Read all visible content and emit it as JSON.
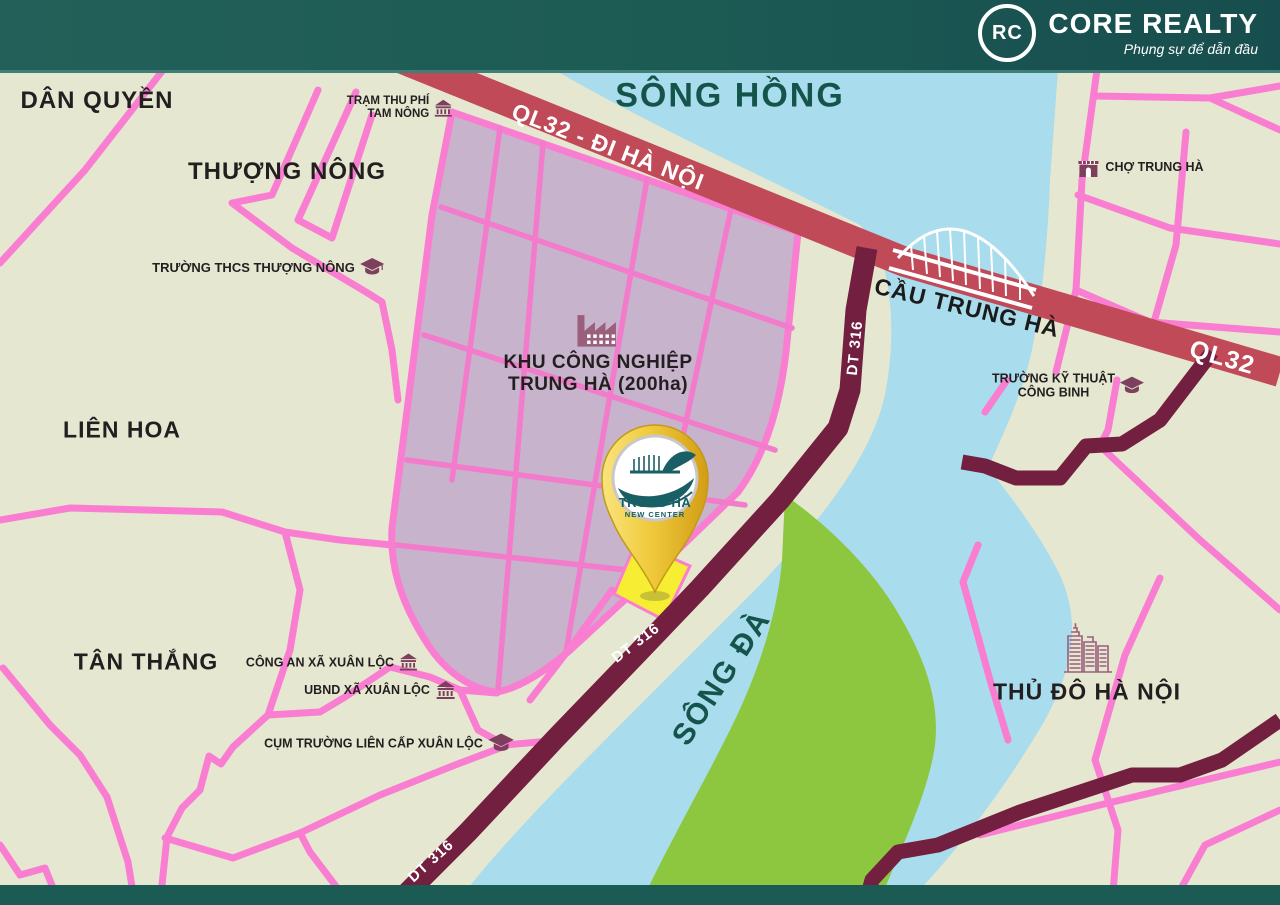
{
  "header": {
    "brand": "CORE REALTY",
    "tagline": "Phụng sự để dẫn đầu",
    "logo_monogram": "RC"
  },
  "colors": {
    "header_teal": "#1c5a54",
    "land": "#e6e7d0",
    "river_blue": "#a9dcec",
    "island_green": "#8dc63f",
    "industrial_zone_mauve": "#c7b3cb",
    "road_pink": "#f97ed2",
    "highway_red": "#c14a58",
    "provincial_road_maroon": "#721f40",
    "river_label_teal": "#15544b",
    "poi_icon_plum": "#7c3f5c",
    "pin_gold": "#edc433",
    "plot_yellow": "#f7ee33"
  },
  "map": {
    "areas": {
      "dan_quyen": "DÂN QUYỀN",
      "thuong_nong": "THƯỢNG NÔNG",
      "lien_hoa": "LIÊN HOA",
      "tan_thang": "TÂN THẮNG",
      "thu_do_ha_noi": "THỦ ĐÔ HÀ NỘI"
    },
    "rivers": {
      "song_hong": "SÔNG HỒNG",
      "song_da": "SÔNG ĐÀ"
    },
    "roads": {
      "ql32_di_ha_noi": "QL32 - ĐI HÀ NỘI",
      "ql32": "QL32",
      "dt316": "DT 316",
      "cau_trung_ha": "CẦU TRUNG HÀ"
    },
    "pois": {
      "tram_thu_phi": {
        "line1": "TRẠM THU PHÍ",
        "line2": "TAM NÔNG",
        "icon": "government-building-icon"
      },
      "truong_thcs": {
        "text": "TRƯỜNG THCS THƯỢNG NÔNG",
        "icon": "graduation-cap-icon"
      },
      "cho_trung_ha": {
        "text": "CHỢ TRUNG HÀ",
        "icon": "market-icon"
      },
      "truong_ky_thuat": {
        "line1": "TRƯỜNG KỸ THUẬT",
        "line2": "CÔNG BINH",
        "icon": "graduation-cap-icon"
      },
      "khu_cong_nghiep": {
        "line1": "KHU CÔNG NGHIỆP",
        "line2": "TRUNG HÀ (200ha)",
        "icon": "factory-icon"
      },
      "cong_an": {
        "text": "CÔNG AN XÃ XUÂN LỘC",
        "icon": "government-building-icon"
      },
      "ubnd": {
        "text": "UBND XÃ XUÂN LỘC",
        "icon": "government-building-icon"
      },
      "cum_truong": {
        "text": "CỤM TRƯỜNG LIÊN CẤP XUÂN LỘC",
        "icon": "graduation-cap-icon"
      },
      "thu_do_icon": "city-buildings-icon"
    },
    "pin": {
      "line1": "TRUNG HÀ",
      "line2": "NEW CENTER"
    }
  }
}
